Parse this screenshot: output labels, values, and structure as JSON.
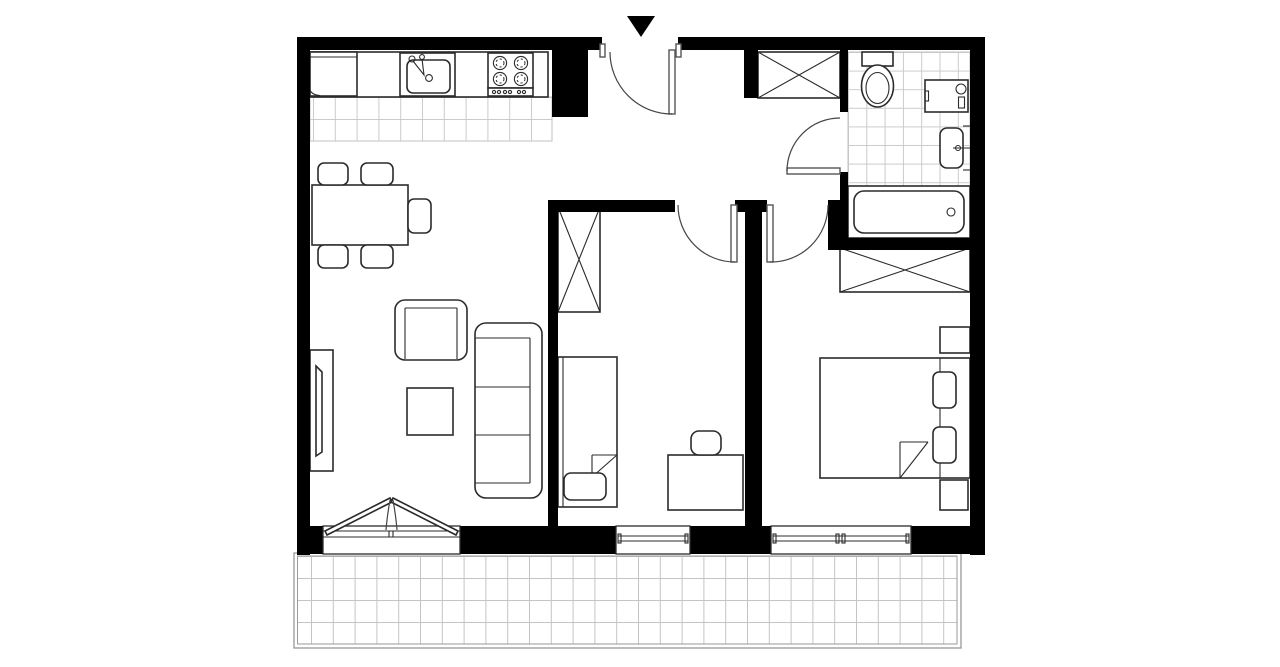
{
  "meta": {
    "kind": "architectural-floor-plan",
    "canvas": {
      "width": 1280,
      "height": 667
    },
    "text_on_image": "none"
  },
  "palette": {
    "wall": "#000000",
    "outline": "#2b2b2b",
    "tile_line": "#cbcbcb",
    "floor": "#ffffff",
    "balcony_border": "#8f8f8f"
  },
  "entrance": {
    "marker_icon": "entrance-arrow-icon",
    "door": "entrance-door",
    "swing": "inward"
  },
  "rooms": [
    {
      "name": "kitchen-living-dining",
      "floor": "white with tiled kitchen strip",
      "items": [
        "fridge",
        "kitchen-counter",
        "kitchen-sink",
        "stove-4-burners",
        "dining-table",
        "dining-chair",
        "dining-chair",
        "dining-chair",
        "dining-chair",
        "dining-chair",
        "armchair",
        "sofa-3-seat",
        "coffee-table",
        "tv-stand",
        "french-balcony-door"
      ]
    },
    {
      "name": "hallway",
      "items": [
        "built-in-closet-crossed",
        "entrance-door"
      ]
    },
    {
      "name": "bedroom-1",
      "items": [
        "wardrobe-crossed",
        "single-bed",
        "pillow",
        "desk",
        "desk-chair",
        "window"
      ]
    },
    {
      "name": "bedroom-2",
      "items": [
        "wardrobe-crossed",
        "double-bed",
        "pillow",
        "pillow",
        "nightstand",
        "nightstand",
        "window"
      ]
    },
    {
      "name": "bathroom",
      "floor": "tiled",
      "items": [
        "toilet",
        "washing-machine",
        "washbasin",
        "bathtub",
        "door"
      ]
    },
    {
      "name": "balcony",
      "floor": "tiled",
      "items": []
    }
  ],
  "symbols": {
    "crossed_rectangle": "wardrobe / storage",
    "quarter_arc": "door swing",
    "grid": "floor tiles",
    "black_triangle": "entrance pointer"
  }
}
